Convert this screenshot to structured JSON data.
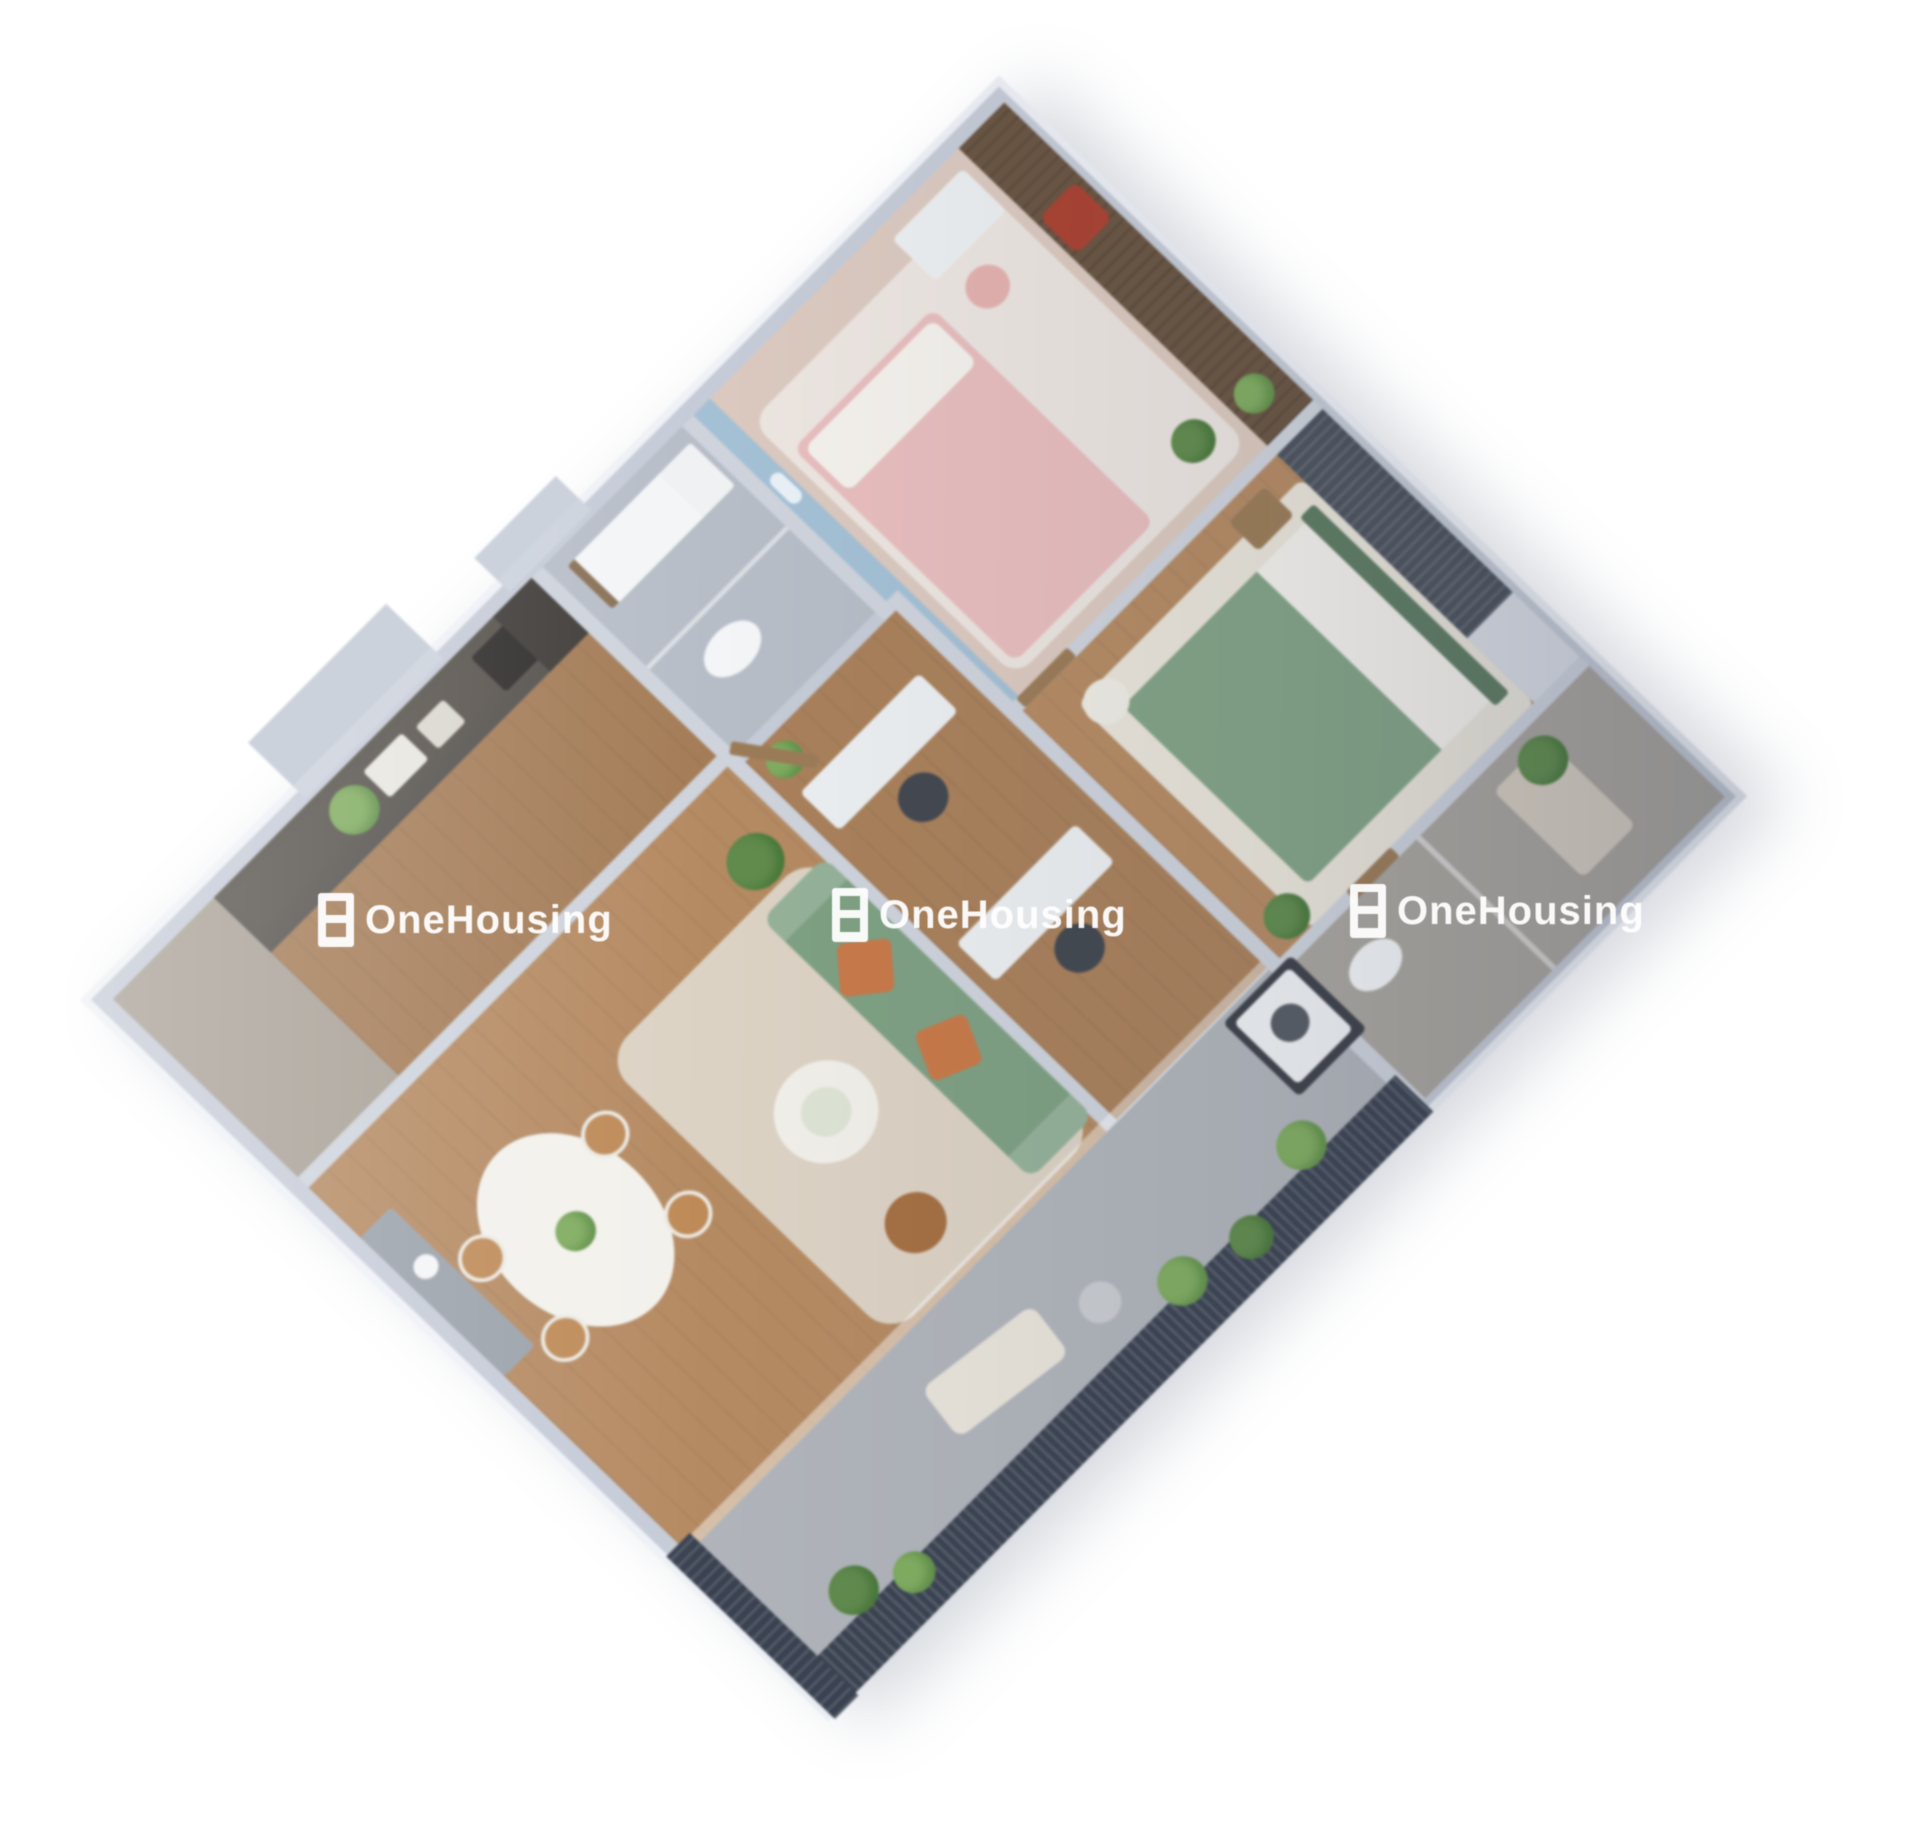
{
  "page": {
    "background": "#ffffff"
  },
  "watermark": {
    "text": "OneHousing",
    "color": "#ffffff",
    "count": 3
  },
  "scene": {
    "type": "3d-isometric-floorplan",
    "subject": "two-bedroom apartment render with kitchen, living-dining room, study nook, two bathrooms and balconies",
    "rotation": "approx -45deg"
  },
  "colors": {
    "background": "#ffffff",
    "wall": "#c5cbd7",
    "wall_top": "#eef1f6",
    "partition": "#ced3dc",
    "wall_step": "#ccd2dc",
    "wood_floor": "#b68a60",
    "wood_floor_mid": "#aa8058",
    "wood_floor_dark": "#a57c55",
    "entry_floor": "#a8a096",
    "cabinet_dark": "#57524c",
    "fridge": "#3f3b38",
    "counter_grey": "#9aa1aa",
    "appliance_white": "#eff1f3",
    "appliance_dark": "#3c4048",
    "white_fixture": "#f3f5f7",
    "bedding_white": "#f4f1ec",
    "bath1_tile": "#b7bdc7",
    "bath2_tile": "#a9a59e",
    "shower_bench": "#d6cdc0",
    "kids_floor": "#dcc9be",
    "kids_mural": "#a3c0d6",
    "cloud": "#e9f1f7",
    "kids_rug": "#ece5e0",
    "kids_bed": "#e9bdbd",
    "kids_chair": "#e5b1ae",
    "desk": "#eceff1",
    "chair_dark": "#42474f",
    "balcony_wood": "#6a5440",
    "red_chair": "#ad4030",
    "master_rug": "#eae5da",
    "master_bed_green": "#81a384",
    "headboard": "#5c7b60",
    "side_table": "#9b7b55",
    "stool": "#efece4",
    "wardrobe": "#4c525c",
    "east_balcony": "#d9dde4",
    "lounge": "#e9e4da",
    "dining_table": "#f2f1ec",
    "dining_chair": "#c08a55",
    "rug": "#dcd2c3",
    "sofa": "#7da081",
    "pillow": "#cb7846",
    "coffee_table": "#f1efe9",
    "plate": "#dde3d4",
    "ottoman": "#a76f40",
    "loggia_floor": "#b0b4ba",
    "railing": "#3a4252",
    "plant": "#5f8c4a",
    "plant_light": "#7fae5e",
    "door_wood": "#9c7b55",
    "metal_grey": "#c9ccd0",
    "watermark": "#ffffff"
  }
}
